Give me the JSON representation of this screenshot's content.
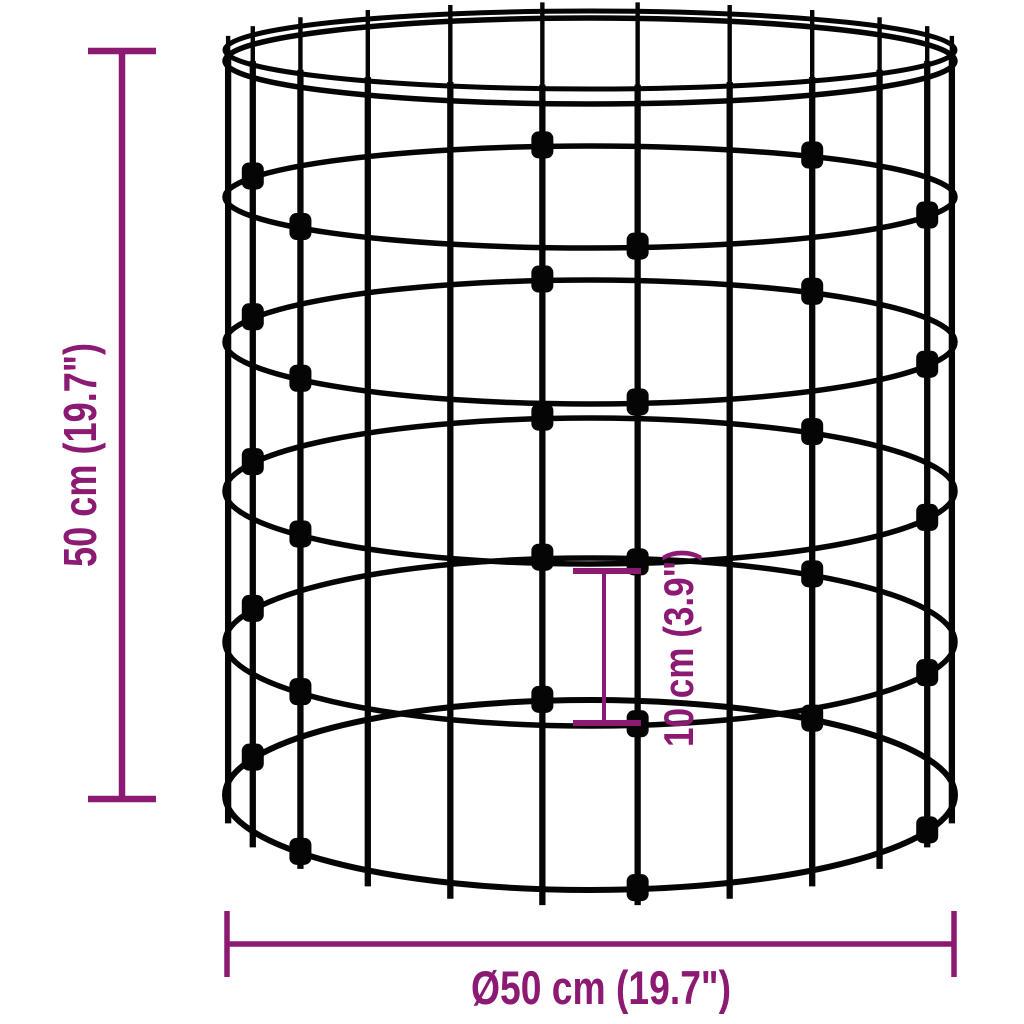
{
  "diagram": {
    "dimensions": {
      "height": {
        "label": "50 cm (19.7\")"
      },
      "ring_spacing": {
        "label": "10 cm (3.9\")"
      },
      "diameter": {
        "label": "Ø50 cm (19.7\")"
      }
    },
    "colors": {
      "dimension": "#8c1a73",
      "wire": "#050505",
      "background": "#ffffff"
    }
  }
}
